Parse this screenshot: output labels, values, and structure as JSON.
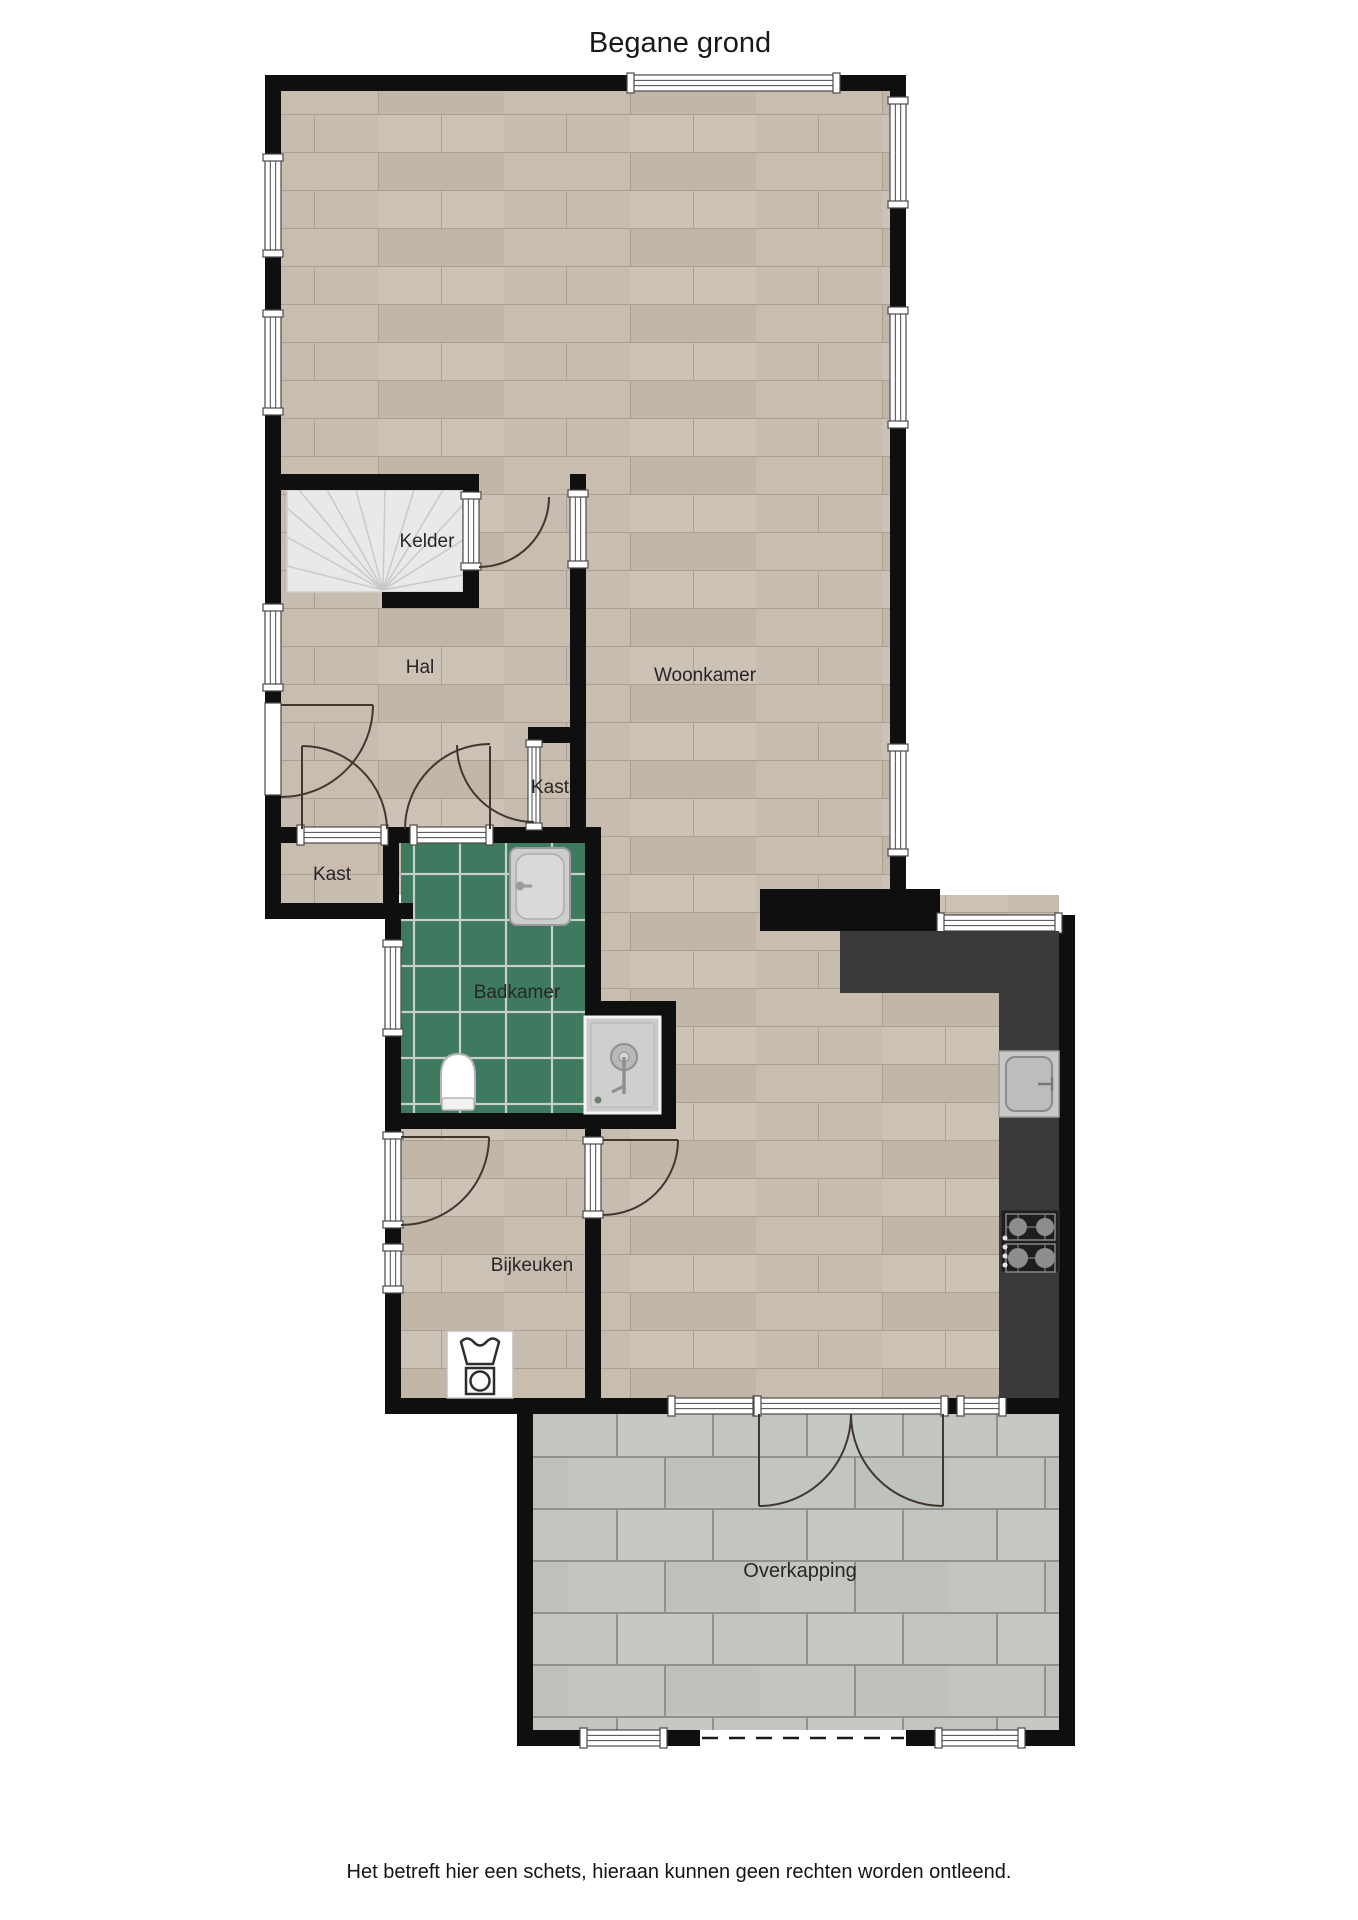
{
  "title": "Begane grond",
  "disclaimer": "Het betreft hier een schets, hieraan kunnen geen rechten worden ontleend.",
  "rooms": {
    "kelder": "Kelder",
    "hal": "Hal",
    "woonkamer": "Woonkamer",
    "kast_middle": "Kast",
    "kast_left": "Kast",
    "badkamer": "Badkamer",
    "bijkeuken": "Bijkeuken",
    "overkapping": "Overkapping"
  },
  "icons": {
    "staircase": "staircase-icon",
    "bathtub": "bathtub-icon",
    "toilet": "toilet-icon",
    "shower": "shower-icon",
    "sink": "sink-icon",
    "stove": "stove-icon",
    "washing_machine": "washing-machine-icon"
  },
  "colors": {
    "wall": "#0f0f0f",
    "wood_floor": "#c7bcb0",
    "bathroom_tile": "#3e7a60",
    "paving": "#c3c5c0",
    "counter": "#3a3a3a",
    "stairs": "#e9e9e9",
    "door_line": "#40382f"
  }
}
